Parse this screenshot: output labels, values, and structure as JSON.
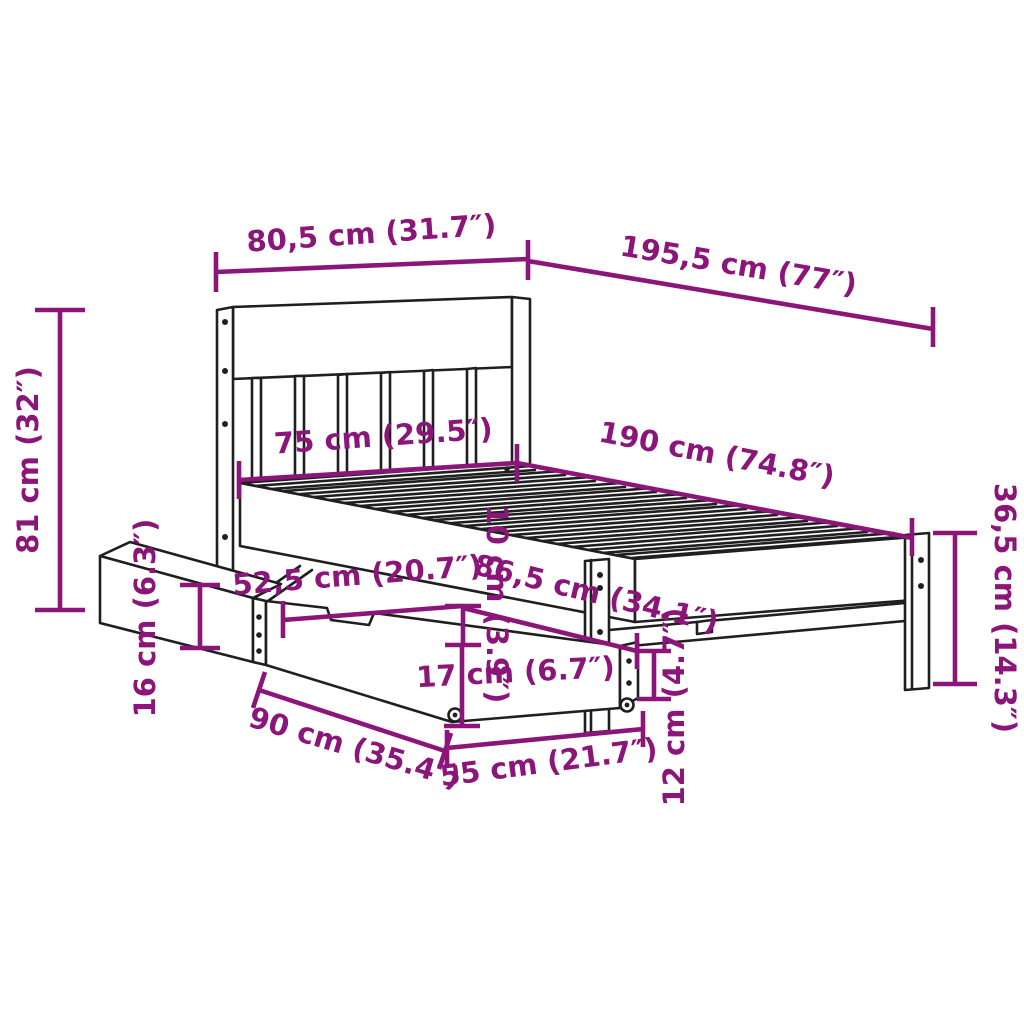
{
  "diagram": {
    "subject": "Bed frame with slatted headboard and two under-bed storage drawers on casters",
    "view": "isometric product dimension drawing",
    "style": {
      "accent_color": "#8b1579",
      "line_color": "#1f1f1f",
      "background_color": "#ffffff"
    }
  },
  "dimensions": {
    "headboard_width": {
      "label": "80,5 cm (31.7″)",
      "cm": "80,5",
      "inch": "31.7"
    },
    "overall_length": {
      "label": "195,5 cm (77″)",
      "cm": "195,5",
      "inch": "77"
    },
    "headboard_height": {
      "label": "81 cm (32″)",
      "cm": "81",
      "inch": "32"
    },
    "inner_width": {
      "label": "75 cm (29.5″)",
      "cm": "75",
      "inch": "29.5"
    },
    "inner_length": {
      "label": "190 cm (74.8″)",
      "cm": "190",
      "inch": "74.8"
    },
    "footend_height": {
      "label": "36,5 cm (14.3″)",
      "cm": "36,5",
      "inch": "14.3"
    },
    "drawer_side_height": {
      "label": "16 cm (6.3″)",
      "cm": "16",
      "inch": "6.3"
    },
    "drawer_top_length": {
      "label": "52,5 cm (20.7″)",
      "cm": "52,5",
      "inch": "20.7"
    },
    "underbed_clearance": {
      "label": "10 cm (3.9″)",
      "cm": "10",
      "inch": "3.9"
    },
    "drawer_unit_length": {
      "label": "86,5 cm (34.1″)",
      "cm": "86,5",
      "inch": "34.1"
    },
    "drawer_front_height": {
      "label": "17 cm (6.7″)",
      "cm": "17",
      "inch": "6.7"
    },
    "floor_clearance": {
      "label": "12 cm (4.7″)",
      "cm": "12",
      "inch": "4.7"
    },
    "drawer_pullout": {
      "label": "90 cm (35.4″)",
      "cm": "90",
      "inch": "35.4"
    },
    "drawer_depth": {
      "label": "55 cm (21.7″)",
      "cm": "55",
      "inch": "21.7"
    }
  }
}
